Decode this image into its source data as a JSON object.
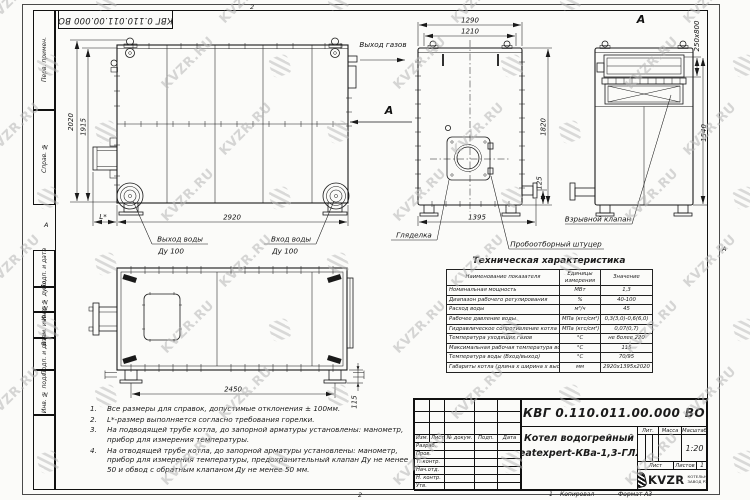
{
  "sheet": {
    "doc_number": "КВГ 0.110.011.00.000 ВО",
    "zone_top": "2",
    "zone_bottom": "2",
    "zone_left": "А",
    "zone_right": "А",
    "footer": {
      "num": "1",
      "kopiroval": "Копировал",
      "format": "Формат А3"
    }
  },
  "watermark": {
    "text": "KVZR.RU"
  },
  "margin_columns": {
    "top_group": [
      "Перв. примен.",
      "Справ. №"
    ],
    "bottom_group": [
      "Подп. и дата",
      "Инв. № дубл.",
      "Взам. инв. №",
      "Подп. и дата",
      "Инв. № подл.",
      ""
    ]
  },
  "views": {
    "side": {
      "dim_height": "2020",
      "dim_height_inner": "1915",
      "dim_width": "2920",
      "dim_burner": "L*",
      "label_gas_out": "Выход газов",
      "label_section": "А",
      "label_water_out": "Выход воды",
      "label_water_out_dn": "Ду 100",
      "label_water_in": "Вход воды",
      "label_water_in_dn": "Ду 100"
    },
    "front": {
      "dim_w1": "1290",
      "dim_w2": "1210",
      "dim_h": "1820",
      "dim_stub": "125",
      "dim_w3": "1395",
      "label_sight": "Гляделка",
      "label_sampler": "Пробоотборный штуцер"
    },
    "rear": {
      "label_view": "А",
      "dim_vent": "250x800",
      "dim_h": "1540",
      "label_valve": "Взрывной клапан"
    },
    "plan": {
      "dim_w": "2450",
      "dim_h": "115"
    }
  },
  "tech_table": {
    "title": "Техническая характеристика",
    "headers": [
      "Наименование показателя",
      "Единицы измерения",
      "Значение"
    ],
    "rows": [
      [
        "Номинальная мощность",
        "МВт",
        "1,3"
      ],
      [
        "Диапазон рабочего регулирования",
        "%",
        "40-100"
      ],
      [
        "Расход воды",
        "м³/ч",
        "45"
      ],
      [
        "Рабочее давление воды",
        "МПа (кгс/см²)",
        "0,3(3,0)-0,6(6,0)"
      ],
      [
        "Гидравлическое сопротивление котла",
        "МПа (кгс/см²)",
        "0,07(0,7)"
      ],
      [
        "Температура уходящих газов",
        "°С",
        "не более 220"
      ],
      [
        "Максимальная рабочая температура воды",
        "°С",
        "115"
      ],
      [
        "Температура воды (Вход/выход)",
        "°С",
        "70/95"
      ],
      [
        "Габариты котла (длина х ширина х высота)",
        "мм",
        "2920х1395х2020"
      ]
    ]
  },
  "notes": {
    "items": [
      "Все размеры для справок, допустимые отклонения ± 100мм.",
      "L*-размер выполняется согласно требования горелки.",
      "На подводящей трубе котла, до запорной арматуры установлены: манометр, прибор для измерения температуры.",
      "На отводящей трубе котла, до запорной арматуры установлены: манометр, прибор для измерения температуры, предохранительный клапан Ду не менее 50 и обвод с обратным клапаном Ду не менее 50 мм."
    ]
  },
  "title_block": {
    "doc_number": "КВГ 0.110.011.00.000 ВО",
    "name_line1": "Котел водогрейный",
    "name_line2": "Heatexpert-КВа-1,3-ГЛЖ",
    "header_cols": [
      "Изм.",
      "Лист",
      "№ докум.",
      "Подп.",
      "Дата"
    ],
    "row_labels": [
      "Разраб.",
      "Пров.",
      "Т. контр.",
      "Нач.отд.",
      "Н. контр.",
      "Утв."
    ],
    "lit_label": "Лит.",
    "mass_label": "Масса",
    "scale_label": "Масштаб",
    "scale_value": "1:20",
    "sheet_label": "Лист",
    "sheets_label": "Листов",
    "sheets_value": "1",
    "logo_text": "KVZR",
    "logo_sub1": "КОТЕЛЬНЫЙ",
    "logo_sub2": "ЗАВОД РЭП"
  }
}
